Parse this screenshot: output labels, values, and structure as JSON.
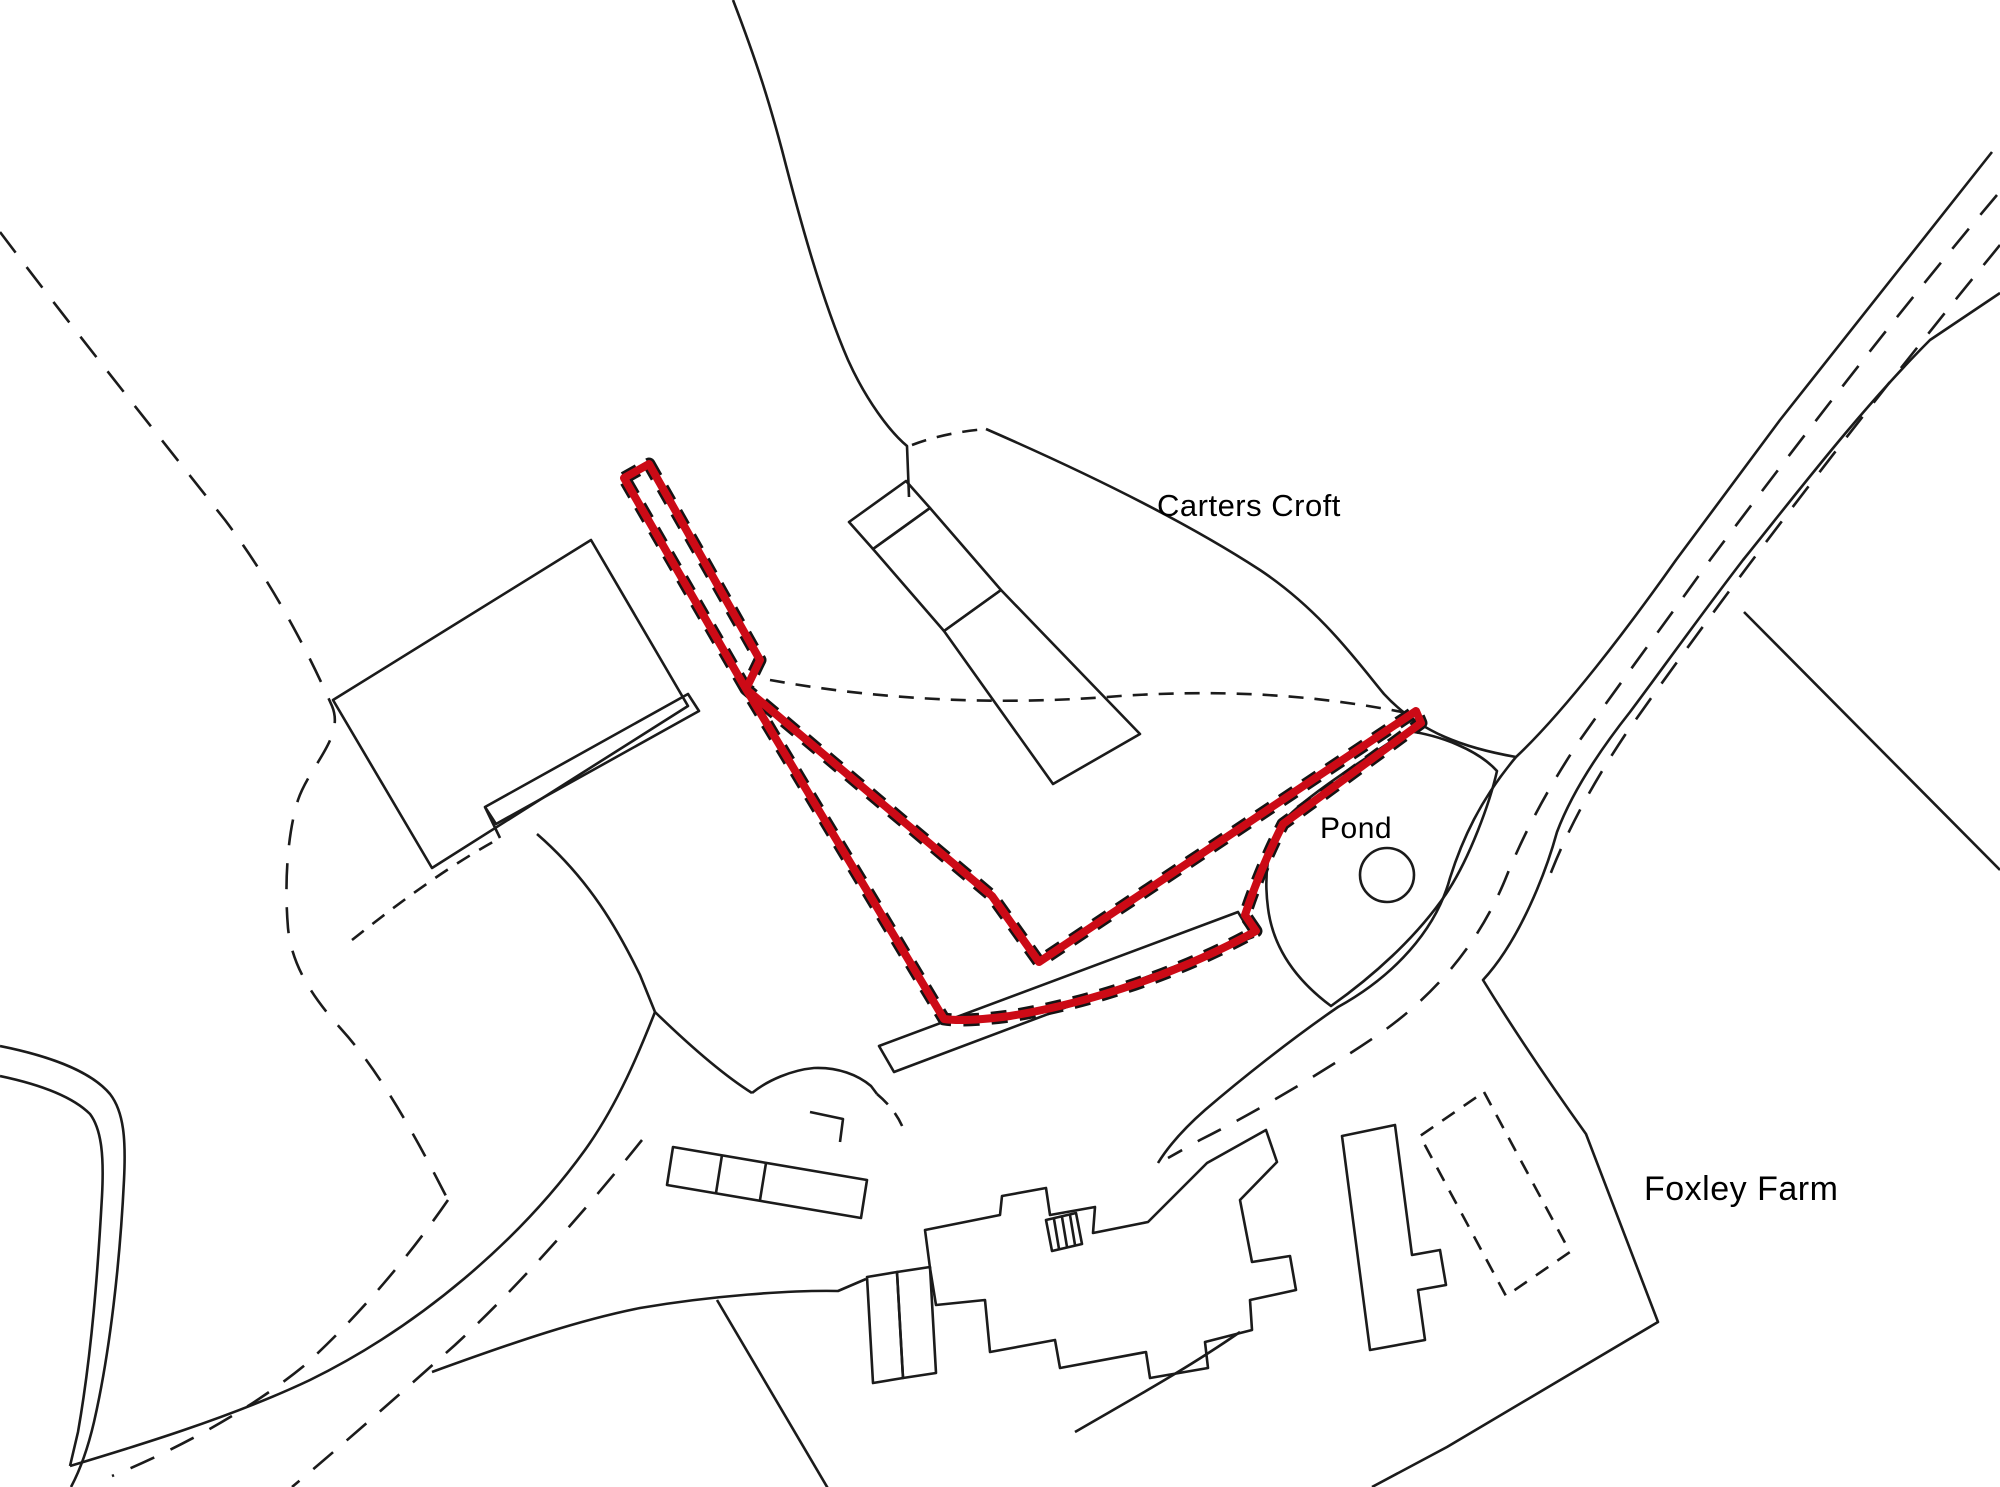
{
  "map": {
    "type": "site-location-plan",
    "background_color": "#ffffff",
    "line_color": "#1b1b1b",
    "labels": {
      "carters_croft": "Carters Croft",
      "pond": "Pond",
      "foxley_farm": "Foxley Farm"
    },
    "site_boundary": {
      "color": "#cc0a16",
      "stroke_width": 8,
      "path": "M 624,478 L 649,464 L 760,660 L 746,689 L 992,896 L 1039,962 L 1416,711 L 1421,723 L 1283,824 C 1266,857 1254,888 1245,915 L 1256,931 C 1180,973 1090,1003 1010,1016 C 980,1020 958,1021 944,1019 L 746,689 L 624,478 Z"
    },
    "pond_circle": {
      "cx": 1387,
      "cy": 875,
      "r": 27
    }
  }
}
